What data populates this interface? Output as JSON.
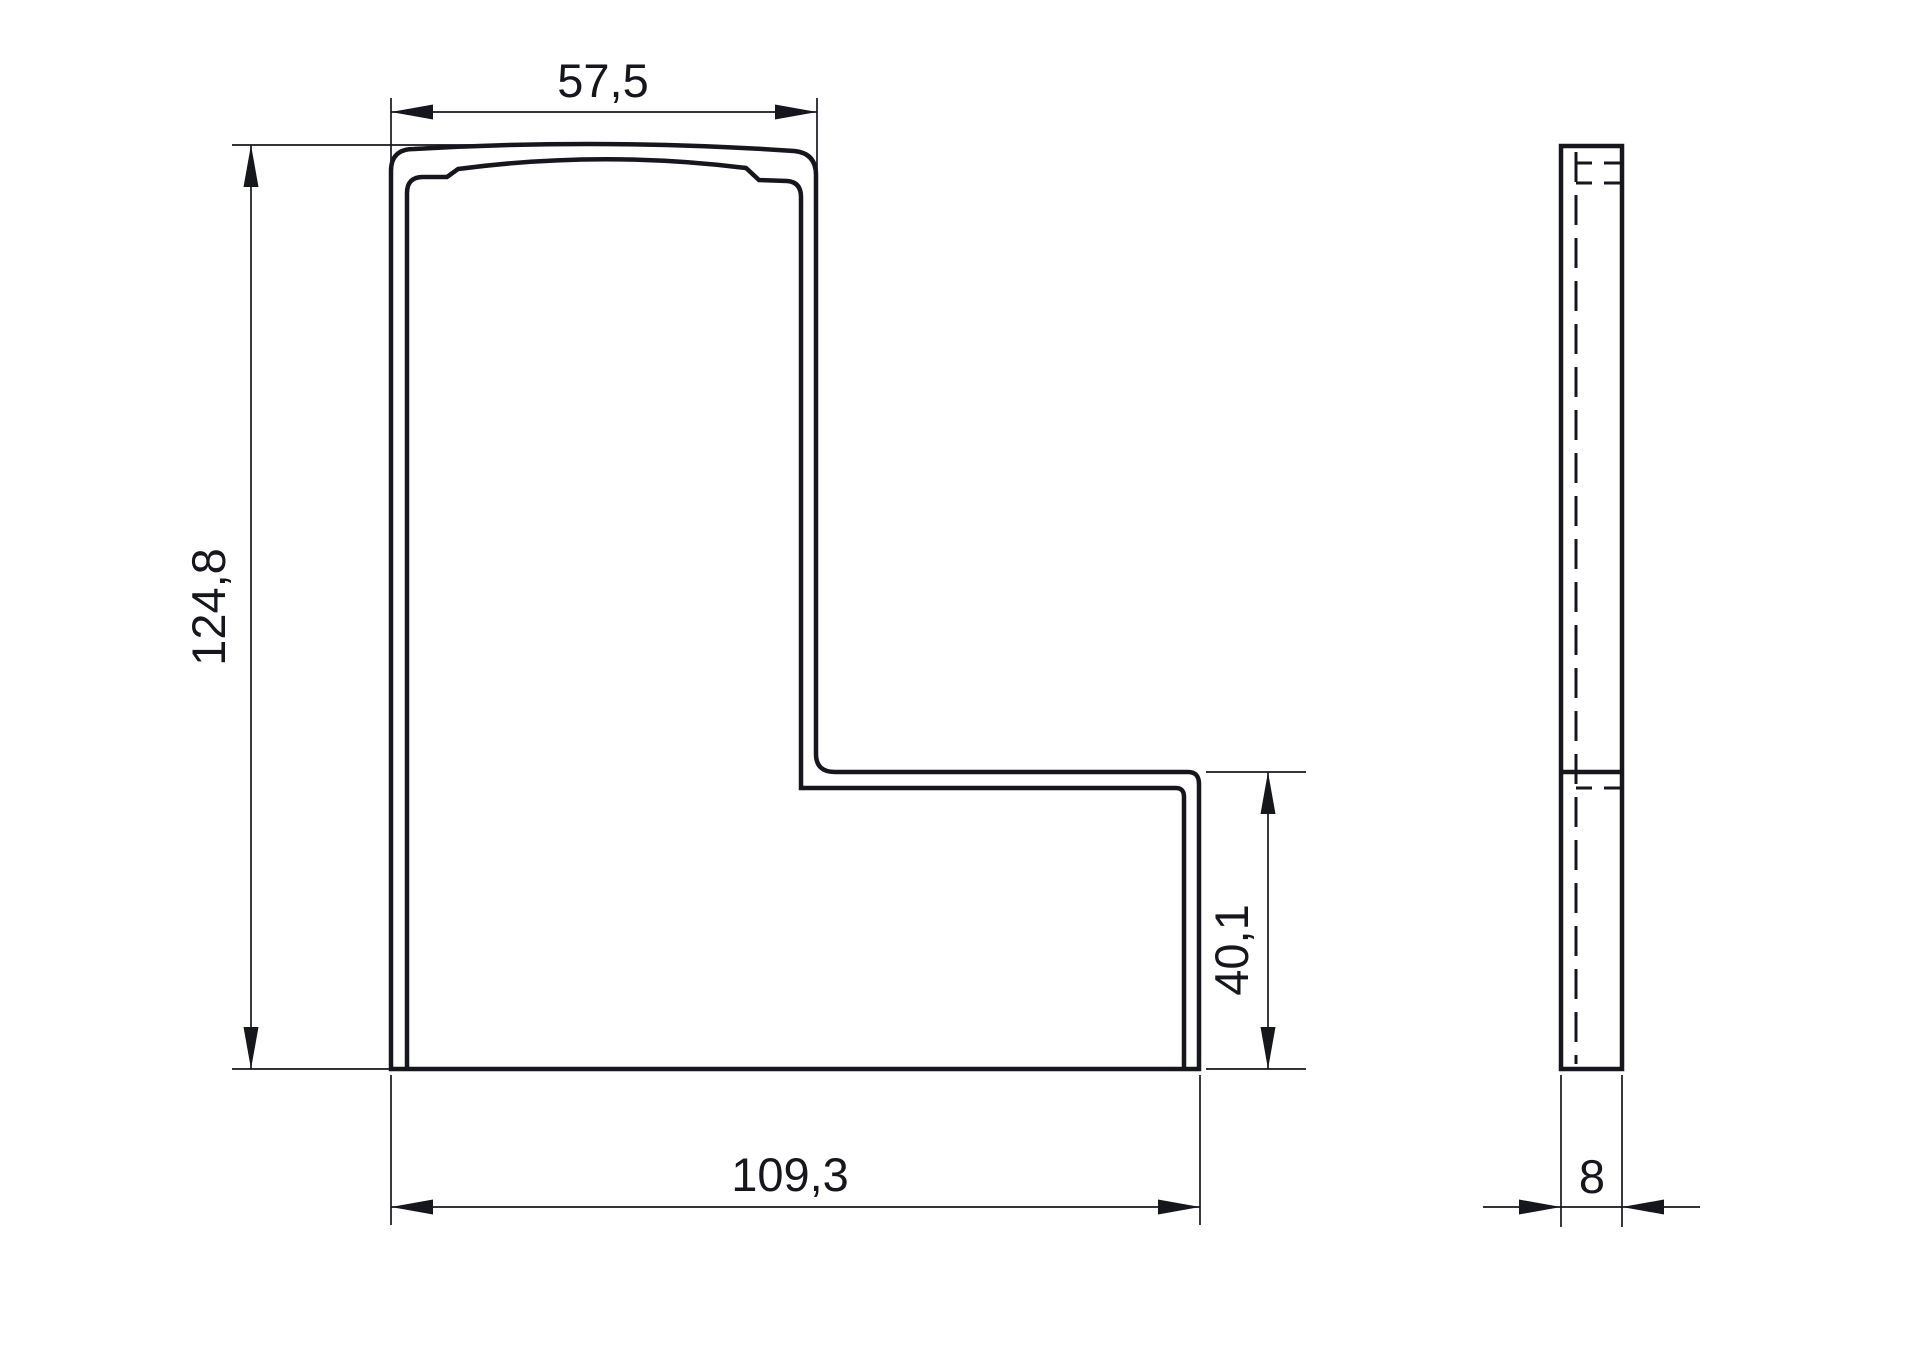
{
  "drawing": {
    "background_color": "#ffffff",
    "line_color": "#16161d",
    "type": "technical-drawing",
    "views": {
      "front": {
        "label": "front-view-l-profile"
      },
      "side": {
        "label": "side-view-thickness"
      }
    },
    "dimensions": {
      "top_width": "57,5",
      "total_height": "124,8",
      "total_width": "109,3",
      "step_height": "40,1",
      "thickness": "8"
    }
  }
}
